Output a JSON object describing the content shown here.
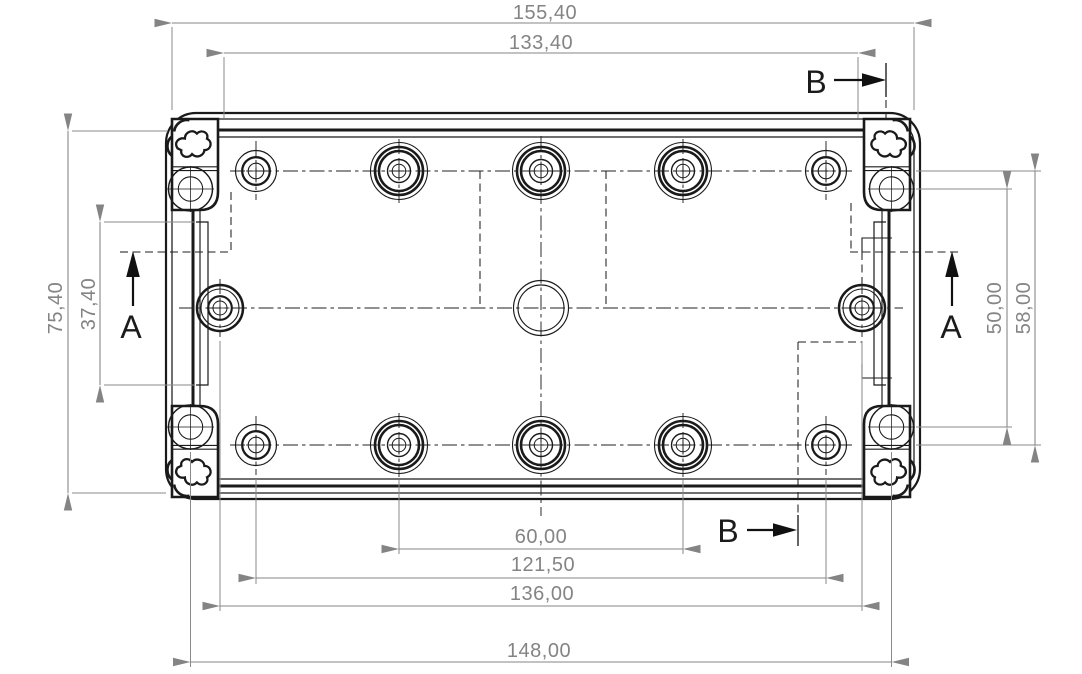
{
  "drawing": {
    "dimensions_mm": {
      "d155": "155,40",
      "d133": "133,40",
      "d75": "75,40",
      "d37": "37,40",
      "d50": "50,00",
      "d58": "58,00",
      "d60": "60,00",
      "d121": "121,50",
      "d136": "136,00",
      "d148": "148,00"
    },
    "section_labels": {
      "a": "A",
      "b": "B"
    },
    "colors": {
      "outline": "#1a1a1a",
      "dimension": "#848484",
      "section_text": "#1b1b1b",
      "background": "#ffffff"
    }
  }
}
